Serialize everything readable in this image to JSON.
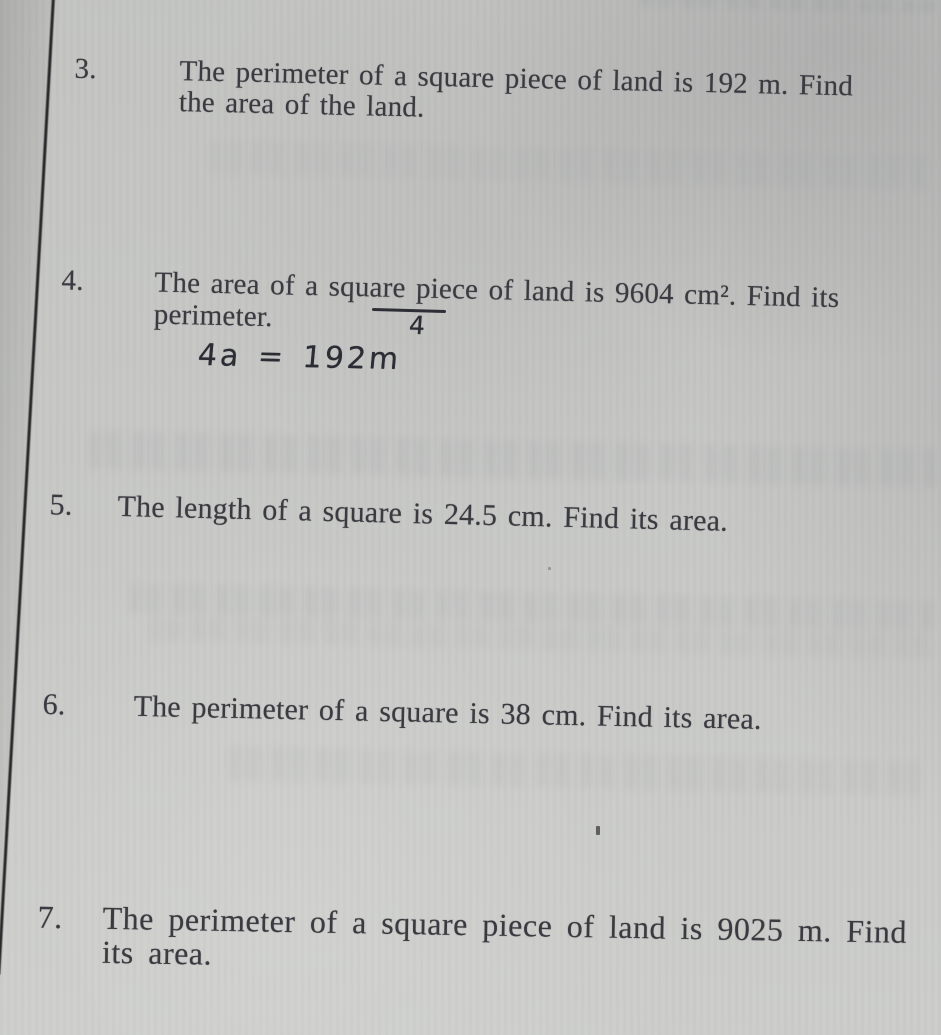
{
  "page": {
    "kind": "photographed textbook exercise page",
    "paper_color": "#c7c8c6",
    "printed_text_color": "#3a3a40",
    "handwriting_ink_color": "#2c2c34",
    "margin_line_color": "#1a1a1c"
  },
  "problems": [
    {
      "number": "3.",
      "lines": [
        "The perimeter of a square piece of land is 192 m. Find",
        "the area of the land."
      ]
    },
    {
      "number": "4.",
      "lines": [
        "The area of a square piece of land is 9604 cm². Find its",
        "perimeter."
      ]
    },
    {
      "number": "5.",
      "lines": [
        "The length of a square is 24.5 cm. Find its area."
      ]
    },
    {
      "number": "6.",
      "lines": [
        "The perimeter of a square is 38 cm. Find its area."
      ]
    },
    {
      "number": "7.",
      "lines": [
        "The perimeter of a square piece of land is 9025 m. Find",
        "its area."
      ]
    }
  ],
  "annotations": {
    "underlined_word": "square",
    "denominator": "4",
    "equation": "4a = 192m"
  }
}
